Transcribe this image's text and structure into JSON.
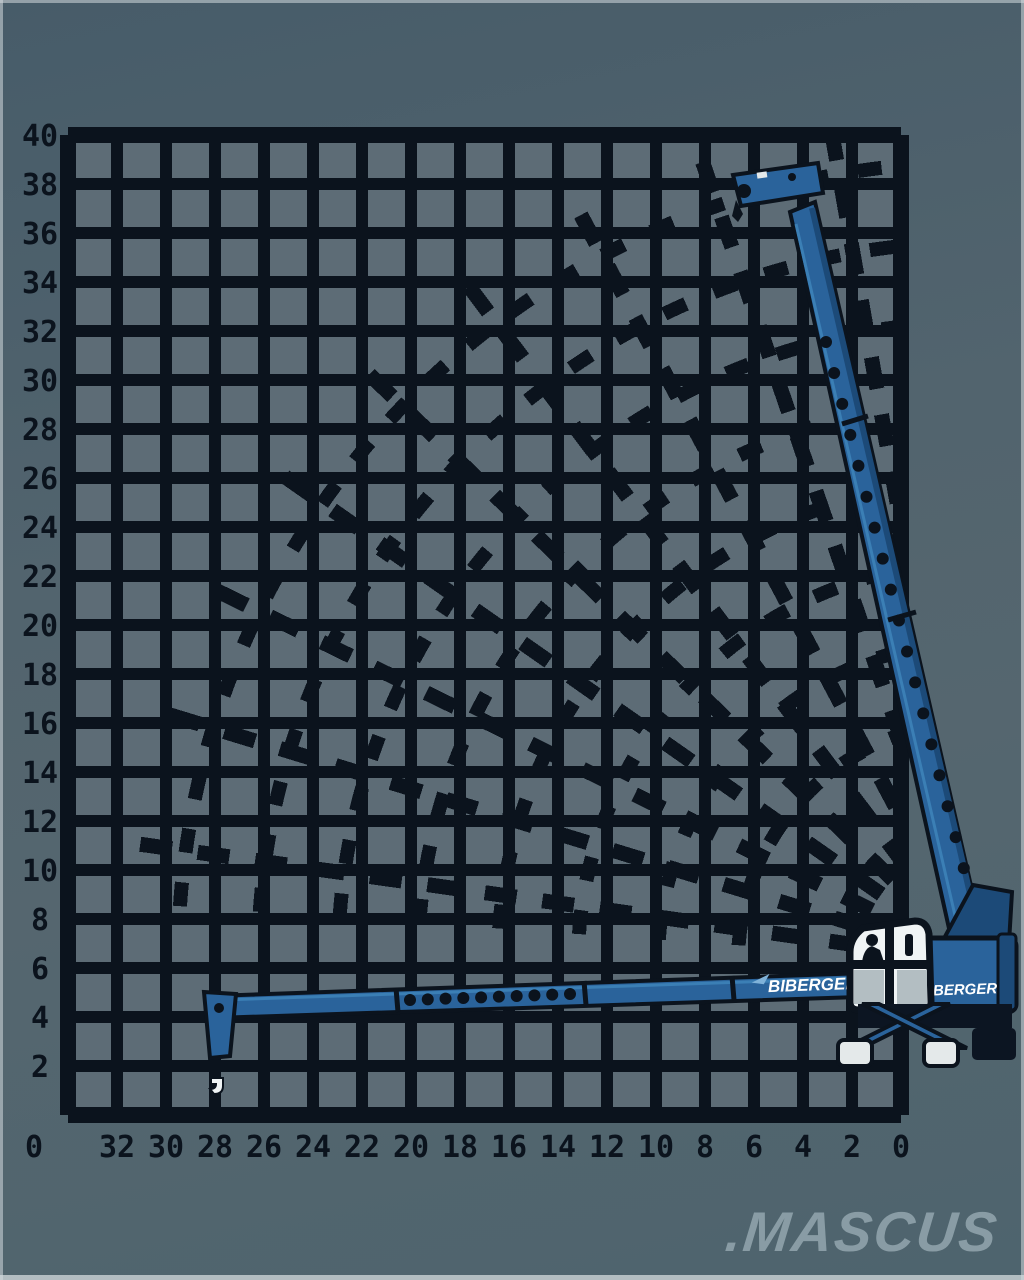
{
  "image": {
    "description": "Pixelated working-range diagram of a BIBERGER telescopic crane shown with boom raised and boom lowered to ground, on a dark grid",
    "line_color": "#0b131d",
    "cell_fill": "#5d6c76",
    "background_top": "#475c69",
    "background_bottom": "#4e646e",
    "edge_highlight": "#d4dbde"
  },
  "brand": {
    "boom_logo": "BIBERGER",
    "body_logo": "BIBERGER",
    "logo_color": "#ffffff",
    "swoosh_color": "#7fb2d9"
  },
  "watermark": {
    "text": ".MASCUS",
    "color": "#8da0a8"
  },
  "crane": {
    "body_color": "#2a639b",
    "shade_color": "#1c4a78",
    "cab_color": "#f0f4f5",
    "pad_color": "#e4e9ea"
  },
  "chart_data": {
    "type": "crane-working-range-diagram",
    "title": "Working range diagram",
    "units": "m",
    "grid": {
      "columns": 17,
      "rows": 20,
      "meters_per_cell": 2,
      "grid_on": true
    },
    "x_axis": {
      "label": "outreach (m)",
      "direction": "right-to-left",
      "tick_labels": [
        "32",
        "30",
        "28",
        "26",
        "24",
        "22",
        "20",
        "18",
        "16",
        "14",
        "12",
        "10",
        "8",
        "6",
        "4",
        "2",
        "0"
      ]
    },
    "y_axis": {
      "label": "height (m)",
      "corner_label": "0",
      "tick_labels": [
        "40",
        "38",
        "36",
        "34",
        "32",
        "30",
        "28",
        "26",
        "24",
        "22",
        "20",
        "18",
        "16",
        "14",
        "12",
        "10",
        "8",
        "6",
        "4",
        "2"
      ]
    },
    "envelope": {
      "max_height_m": 40,
      "max_outreach_m": 33,
      "boom_positions_deg": [
        8,
        17,
        26,
        35,
        44,
        53,
        62,
        71,
        80
      ],
      "hook_path_radii_m": [
        10,
        13,
        16,
        20,
        23,
        26,
        29,
        33
      ],
      "shown_boom_states": [
        "boom raised ~75 deg",
        "boom horizontal at ground level"
      ]
    },
    "figure_geometry": {
      "x0": 68,
      "y0": 135,
      "cell_px": 49,
      "cols": 17,
      "rows": 20,
      "pivot": [
        978,
        962
      ],
      "fan_angles_deg": [
        8,
        17,
        26,
        35,
        44,
        53,
        62,
        71,
        80
      ],
      "fan_radius_px": 850,
      "arc_radii_px": [
        240,
        320,
        400,
        480,
        560,
        640,
        720,
        800
      ],
      "line_width": 15,
      "line_dash": "32 26",
      "arc_dash": "24 30",
      "boom_holes_raised": {
        "x1": 826,
        "y1": 342,
        "x2": 980,
        "y2": 930,
        "n": 20,
        "r": 6
      },
      "boom_holes_ground": {
        "x1": 410,
        "y1": 1000,
        "x2": 570,
        "y2": 994,
        "n": 10,
        "r": 6
      }
    }
  }
}
